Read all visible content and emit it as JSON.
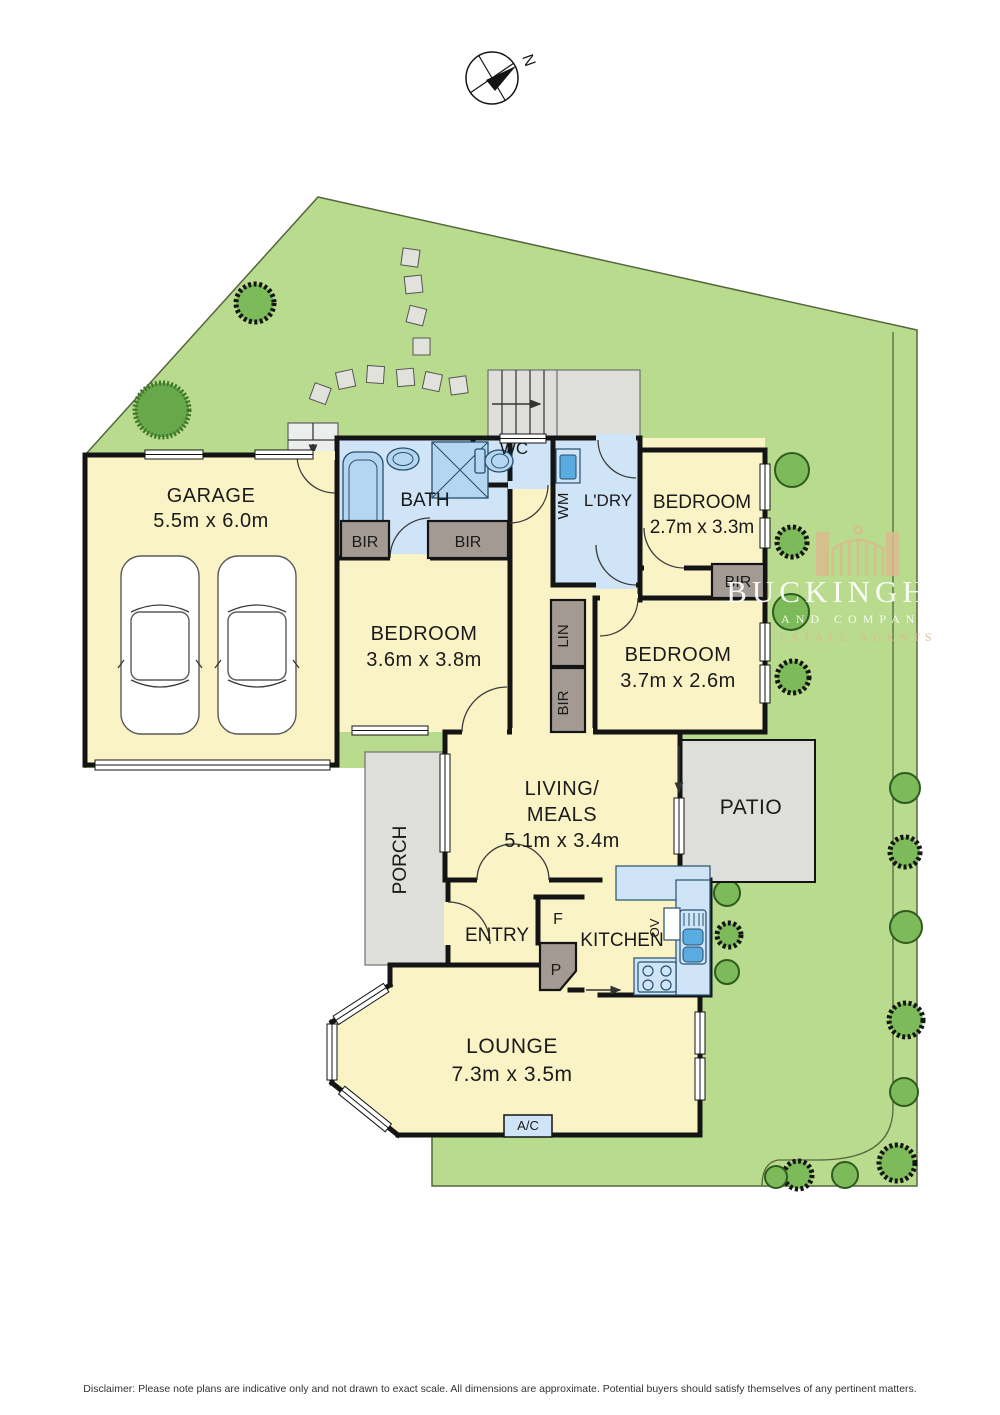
{
  "compass": {
    "north_label": "N"
  },
  "rooms": {
    "garage": {
      "name": "GARAGE",
      "dims": "5.5m x 6.0m"
    },
    "bath": {
      "name": "BATH"
    },
    "wc": {
      "name": "WC"
    },
    "laundry": {
      "name": "L'DRY"
    },
    "bedroom_top": {
      "name": "BEDROOM",
      "dims": "2.7m x 3.3m"
    },
    "bedroom_mid": {
      "name": "BEDROOM",
      "dims": "3.6m x 3.8m"
    },
    "bedroom_right": {
      "name": "BEDROOM",
      "dims": "3.7m x 2.6m"
    },
    "living": {
      "name_line1": "LIVING/",
      "name_line2": "MEALS",
      "dims": "5.1m x 3.4m"
    },
    "patio": {
      "name": "PATIO"
    },
    "porch": {
      "name": "PORCH"
    },
    "entry": {
      "name": "ENTRY"
    },
    "kitchen": {
      "name": "KITCHEN"
    },
    "lounge": {
      "name": "LOUNGE",
      "dims": "7.3m x 3.5m"
    }
  },
  "fixtures": {
    "wm": "WM",
    "bir": "BIR",
    "lin": "LIN",
    "fridge": "F",
    "pantry": "P",
    "oven": "OV",
    "ac": "A/C"
  },
  "watermark": {
    "brand": "BUCKINGHAM",
    "sub": "AND COMPANY",
    "tagline": "ESTATE AGENTS"
  },
  "footer": {
    "disclaimer": "Disclaimer: Please note plans are indicative only and not drawn to exact scale. All dimensions are approximate. Potential buyers should satisfy themselves of any pertinent matters."
  },
  "colors": {
    "lawn": "#b9db8d",
    "room_floor": "#faf3c6",
    "wet_floor": "#cfe4f7",
    "hard_surface": "#dedfda",
    "cabinet": "#a39a93",
    "wall": "#141414",
    "appliance_blue": "#5aace0",
    "tree_green": "#7cba5a",
    "watermark_tan": "#d9ba8e"
  }
}
